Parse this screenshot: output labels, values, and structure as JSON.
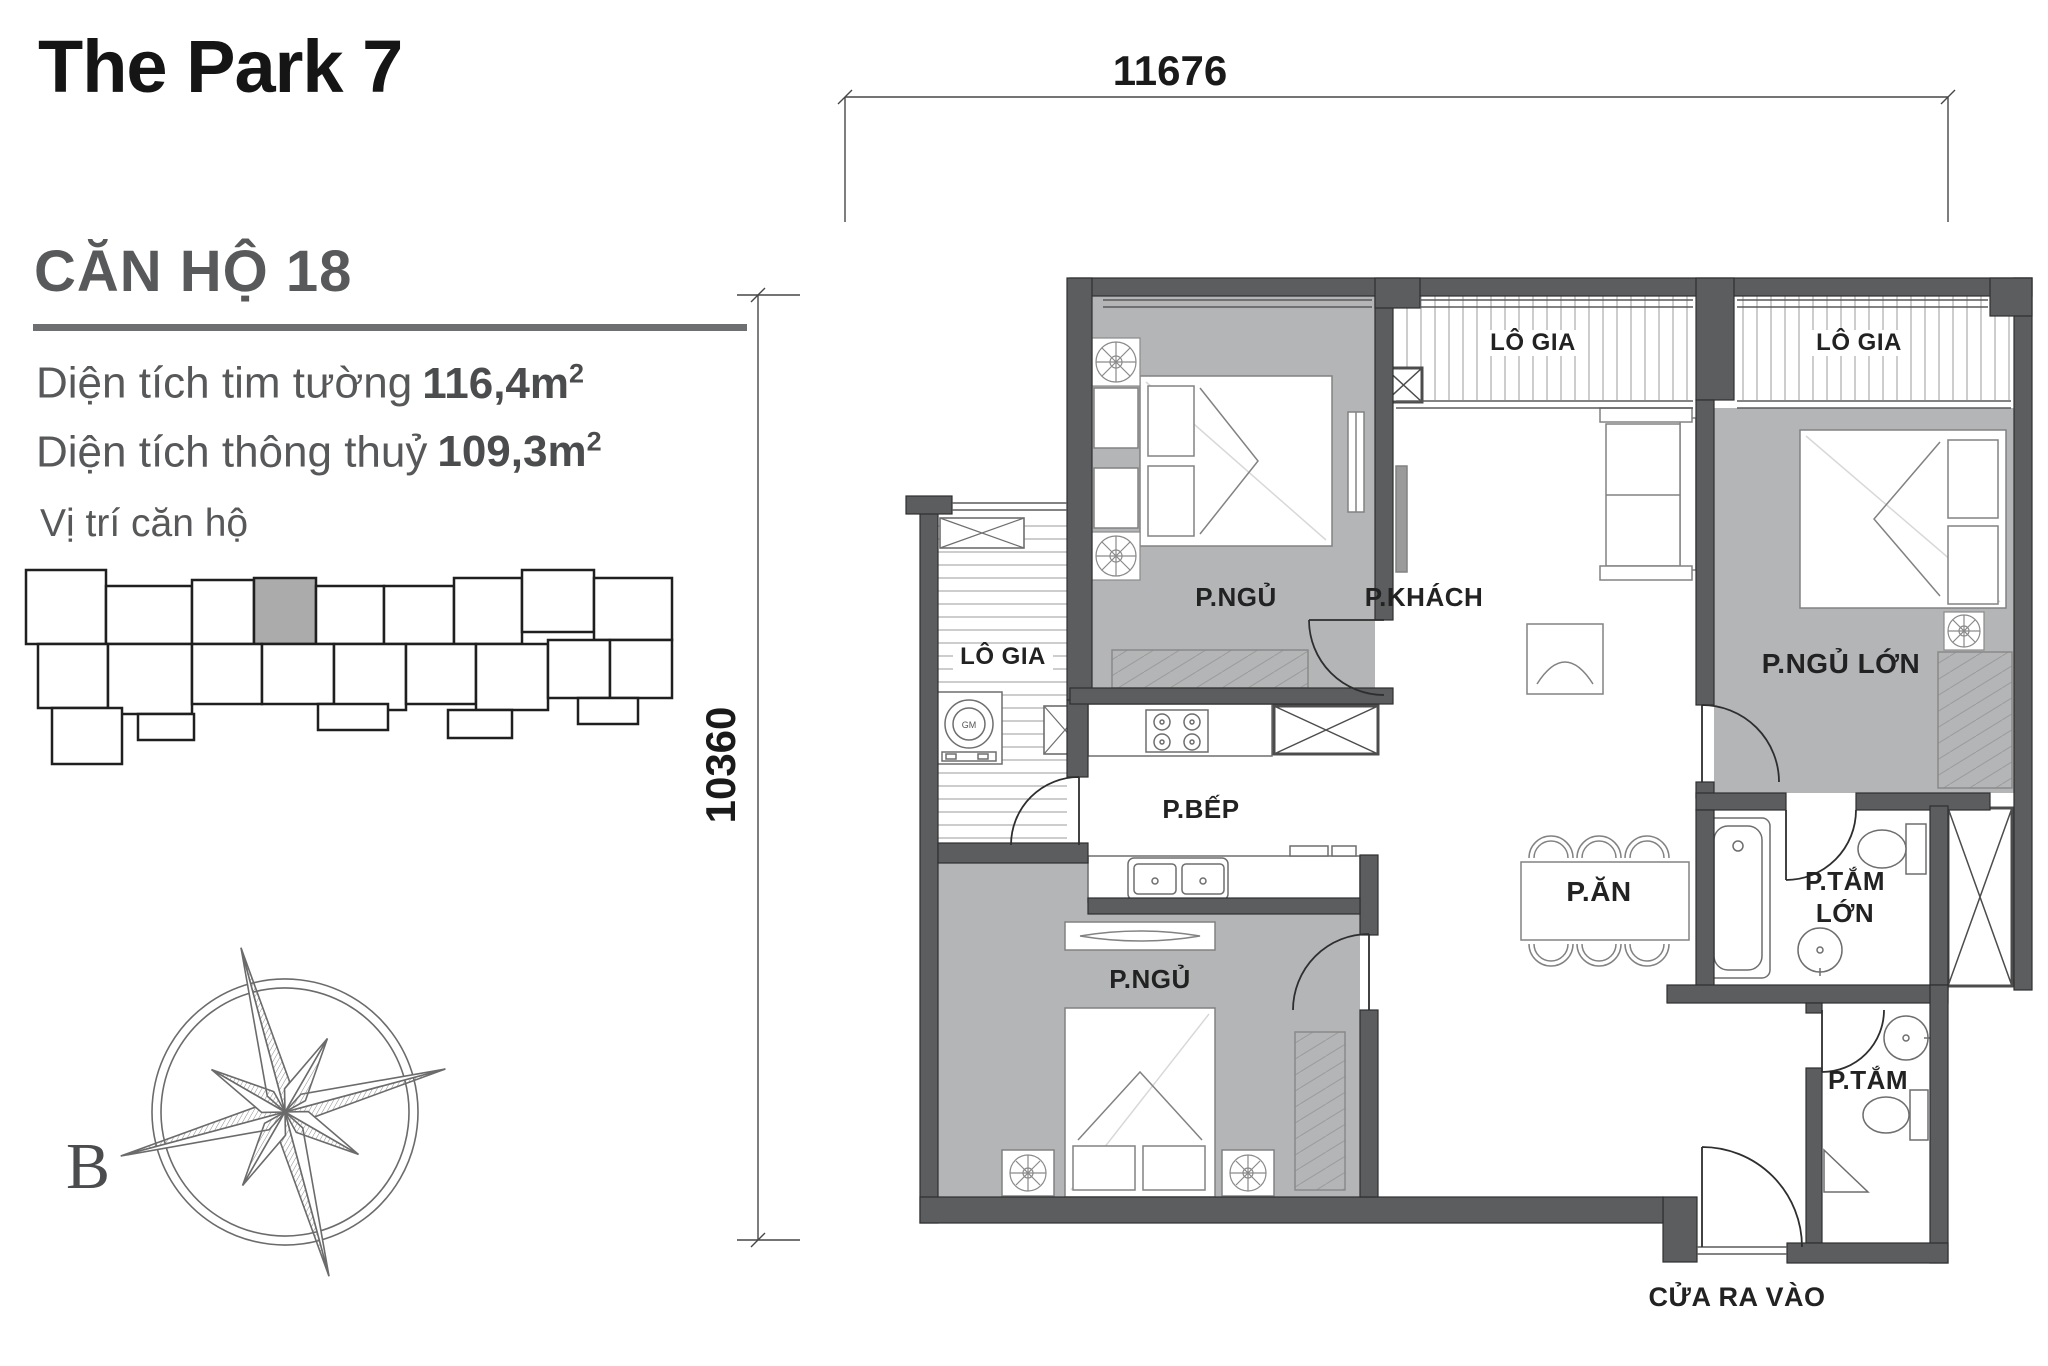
{
  "header": {
    "title": "The Park 7",
    "apartment": "CĂN HỘ 18",
    "areas": [
      {
        "label": "Diện tích tim tường",
        "value": "116,4",
        "unit": "m",
        "sup": "2"
      },
      {
        "label": "Diện tích thông thuỷ",
        "value": "109,3",
        "unit": "m",
        "sup": "2"
      }
    ],
    "location_label": "Vị trí căn hộ"
  },
  "compass": {
    "north_label": "B"
  },
  "plan": {
    "dim_width": "11676",
    "dim_height": "10360",
    "rooms": {
      "bedroom_top": "P.NGỦ",
      "living": "P.KHÁCH",
      "master_bedroom": "P.NGỦ LỚN",
      "loggia_top_left": "LÔ GIA",
      "loggia_top_right": "LÔ GIA",
      "loggia_left": "LÔ GIA",
      "kitchen": "P.BẾP",
      "dining": "P.ĂN",
      "master_bath_line1": "P.TẮM",
      "master_bath_line2": "LỚN",
      "bath": "P.TẮM",
      "bedroom_bottom": "P.NGỦ",
      "entrance": "CỬA RA VÀO"
    },
    "washer_label": "GM"
  }
}
